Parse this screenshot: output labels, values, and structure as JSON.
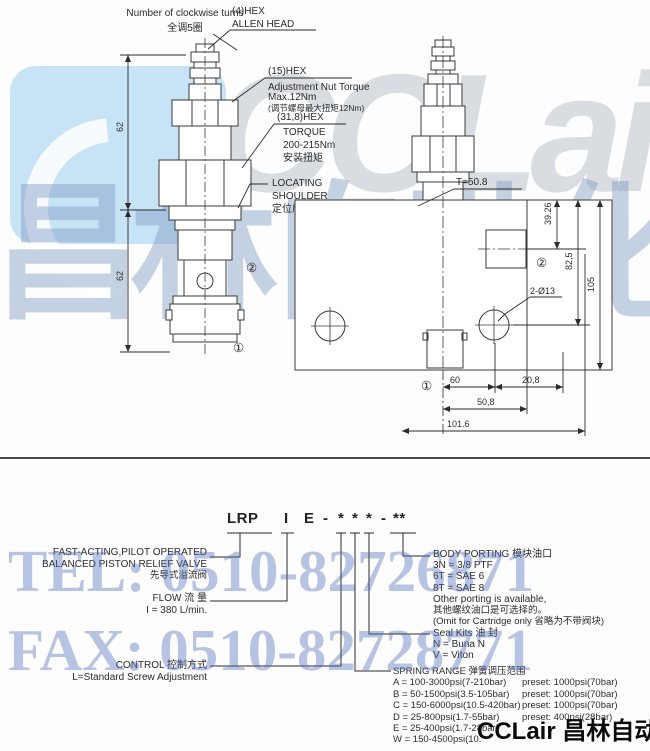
{
  "watermarks": {
    "logo_text": "CCLair",
    "brand_cn": "昌林自动化",
    "tel": "TEL: 0510-82726871",
    "fax": "FAX: 0510-82728771",
    "footer": "CCLair 昌林自动化"
  },
  "drawing": {
    "left": {
      "turns_en": "Number of clockwise turns",
      "turns_cn": "全调5圈",
      "allen_1": "(4)HEX",
      "allen_2": "ALLEN HEAD",
      "hex15": "(15)HEX",
      "nut_torque_1": "Adjustment Nut Torque",
      "nut_torque_2": "Max.12Nm",
      "nut_torque_cn": "(调节螺母最大扭矩12Nm)",
      "hex318": "(31,8)HEX",
      "torque_1": "TORQUE",
      "torque_2": "200-215Nm",
      "torque_cn": "安装扭矩",
      "shoulder_1": "LOCATING",
      "shoulder_2": "SHOULDER",
      "shoulder_cn": "定位肩部",
      "dim_upper": "62",
      "dim_lower": "62",
      "port1": "①",
      "port2": "②"
    },
    "block": {
      "t_label": "T=50.8",
      "dim_3926": "39.26",
      "dim_825": "82,5",
      "dim_105": "105",
      "holes": "2-Ø13",
      "dim_60": "60",
      "dim_208": "20,8",
      "dim_508": "50,8",
      "dim_1016": "101.6",
      "port1": "①",
      "port2": "②"
    }
  },
  "model_code": {
    "segments": [
      "LRP",
      "I",
      "E",
      "-",
      "*",
      "*",
      "*",
      "-",
      "**"
    ]
  },
  "sections": {
    "valve_type": {
      "line1": "FAST-ACTING,PILOT OPERATED",
      "line2": "BALANCED PISTON RELIEF VALVE",
      "line3": "先导式溢流阀"
    },
    "flow": {
      "title": "FLOW 流 量",
      "value": "I = 380 L/min."
    },
    "control": {
      "title": "CONTROL 控制方式",
      "value": "L=Standard Screw Adjustment"
    },
    "body_porting": {
      "title": "BODY PORTING 模块油口",
      "options": [
        "3N = 3/8 PTF",
        "6T = SAE 6",
        "8T = SAE 8",
        "Other porting is available,",
        "其他螺纹油口是可选择的。",
        "(Omit for Cartridge only 省略为不带阀块)"
      ]
    },
    "seal_kits": {
      "title": "Seal Kits 油 封",
      "options": [
        "N = Buna N",
        "V = Viton"
      ]
    },
    "spring_range": {
      "title": "SPRING RANGE 弹簧调压范围",
      "rows": [
        {
          "range": "A = 100-3000psi(7-210bar)",
          "preset": "preset: 1000psi(70bar)"
        },
        {
          "range": "B = 50-1500psi(3.5-105bar)",
          "preset": "preset: 1000psi(70bar)"
        },
        {
          "range": "C = 150-6000psi(10.5-420bar)",
          "preset": "preset: 1000psi(70bar)"
        },
        {
          "range": "D = 25-800psi(1.7-55bar)",
          "preset": "preset: 400psi(28bar)"
        },
        {
          "range": "E = 25-400psi(1.7-28bar)",
          "preset": ""
        },
        {
          "range": "W = 150-4500psi(10.",
          "preset": ""
        }
      ]
    }
  }
}
